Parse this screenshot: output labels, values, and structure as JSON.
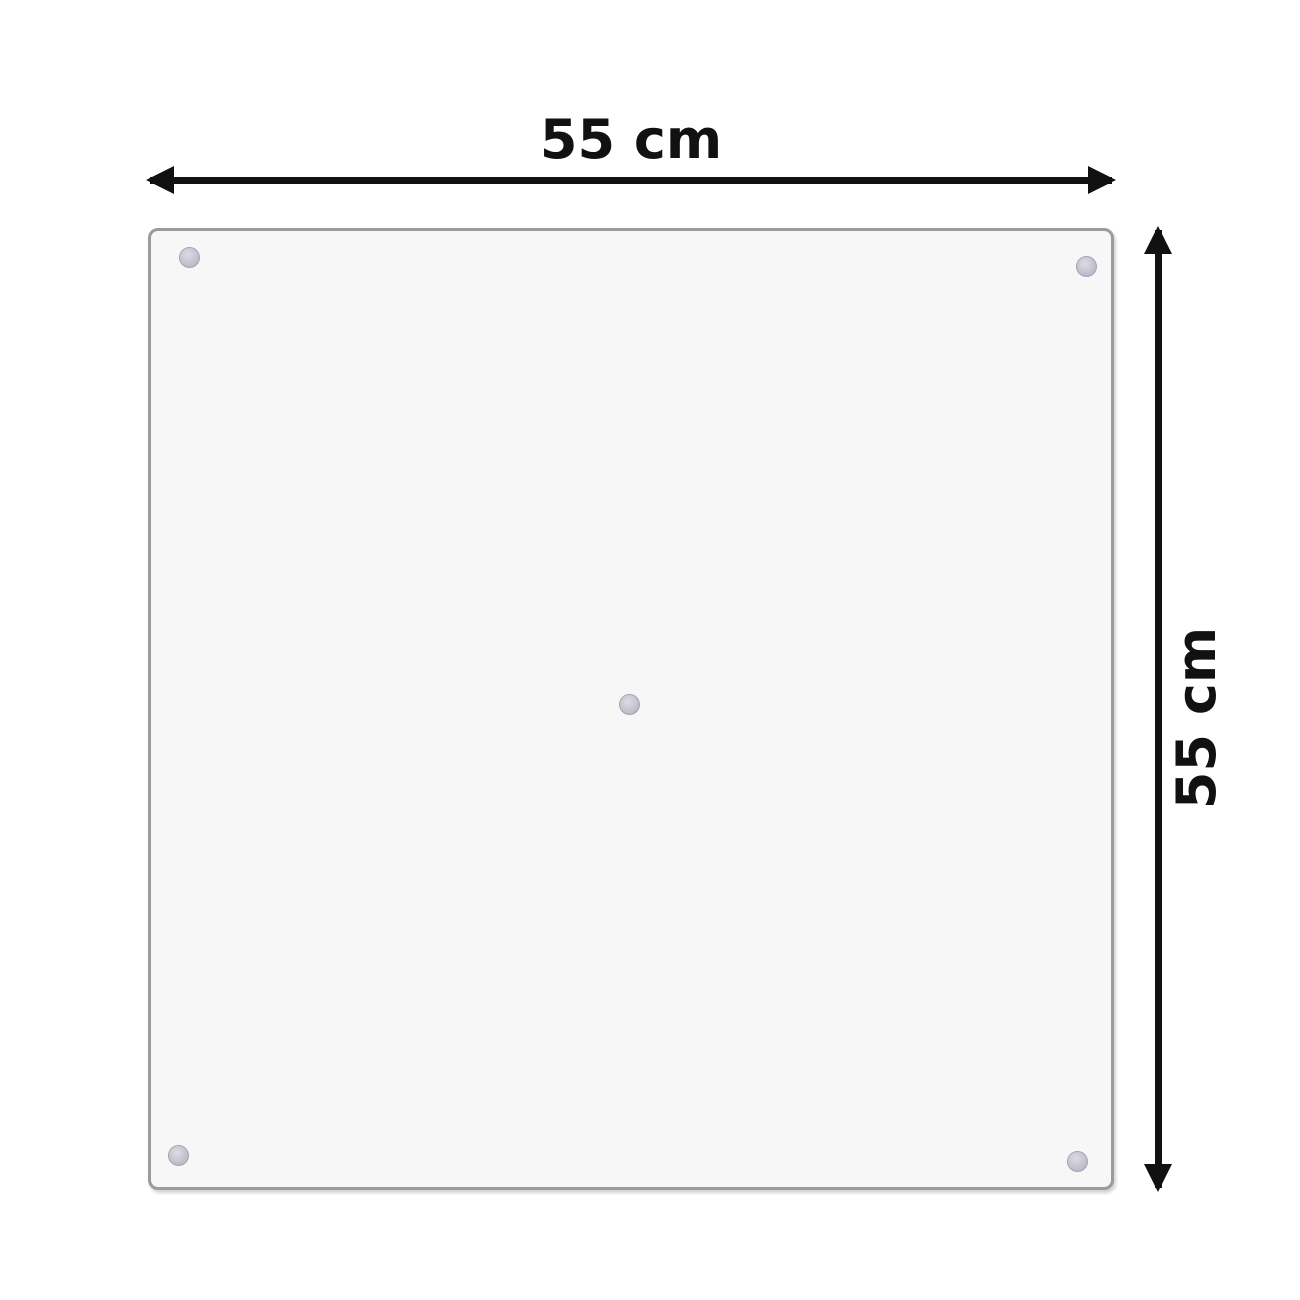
{
  "diagram": {
    "title": "panel-dimension-diagram",
    "width_label": "55 cm",
    "height_label": "55 cm",
    "width_cm": 55,
    "height_cm": 55,
    "panel": {
      "shape": "square",
      "fill_color": "#f7f7f8",
      "border_color": "#9b9b9b",
      "mount_dot_color": "#c4c1ce",
      "mount_dots": [
        "top-left",
        "top-right",
        "center",
        "bottom-left",
        "bottom-right"
      ]
    },
    "arrow_color": "#111111",
    "background_color": "#ffffff"
  }
}
